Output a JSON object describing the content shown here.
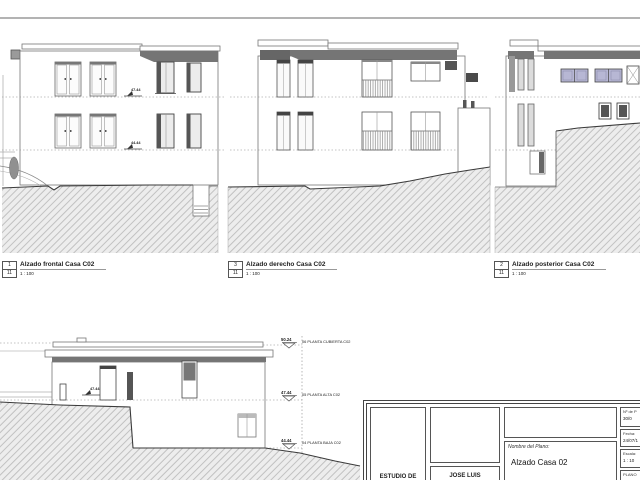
{
  "sheet_views": [
    {
      "num": "1",
      "total": "11",
      "title": "Alzado frontal Casa C02",
      "scale": "1 : 100"
    },
    {
      "num": "3",
      "total": "11",
      "title": "Alzado derecho Casa C02",
      "scale": "1 : 100"
    },
    {
      "num": "2",
      "total": "11",
      "title": "Alzado posterior Casa C02",
      "scale": "1 : 100"
    }
  ],
  "level_markers": [
    {
      "value": "50.24",
      "label": "06 PLANTA CUBIERTA C02"
    },
    {
      "value": "47.44",
      "label": "05 PLANTA ALTA C02"
    },
    {
      "value": "44.44",
      "label": "04 PLANTA BAJA C02"
    }
  ],
  "inline_markers": {
    "front_upper": "47.44",
    "front_lower": "44.44",
    "section_upper": "47.44"
  },
  "title_block": {
    "studio": "ESTUDIO DE",
    "architect": "JOSE LUIS",
    "plan_label": "Nombre del Plano:",
    "plan_name": "Alzado Casa 02",
    "sheet_no_label": "Nº de P",
    "sheet_no": "30/0",
    "date_label": "Fecha:",
    "date": "24/07/1",
    "scale_label": "Escala:",
    "scale": "1 : 10",
    "plano_label": "PLANO"
  },
  "colors": {
    "fascia": "#757575",
    "window_tint": "#b7b7d4",
    "hatch_bg": "#ededed",
    "hatch_line": "#bcbcbc",
    "ground_line": "#3a3a3a"
  }
}
